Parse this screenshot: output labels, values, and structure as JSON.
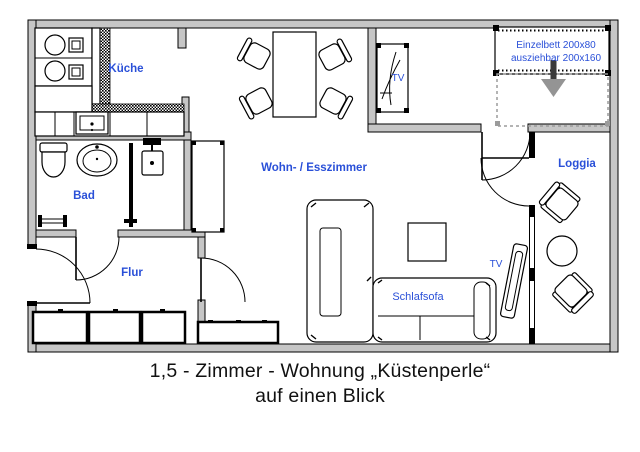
{
  "caption": {
    "line1": "1,5 - Zimmer - Wohnung „Küstenperle“",
    "line2": "auf einen Blick"
  },
  "rooms": {
    "kitchen": "Küche",
    "bath": "Bad",
    "hall": "Flur",
    "living": "Wohn- / Esszimmer",
    "loggia": "Loggia"
  },
  "furniture": {
    "sofa": "Schlafsofa",
    "tv_alcove": "TV",
    "tv_living": "TV",
    "bed_line1": "Einzelbett 200x80",
    "bed_line2": "ausziehbar 200x160"
  },
  "colors": {
    "label_blue": "#2a50d8",
    "wall_gray": "#c6c6c6",
    "ghost_gray": "#9b9b9b",
    "arrow_gray": "#949494"
  }
}
